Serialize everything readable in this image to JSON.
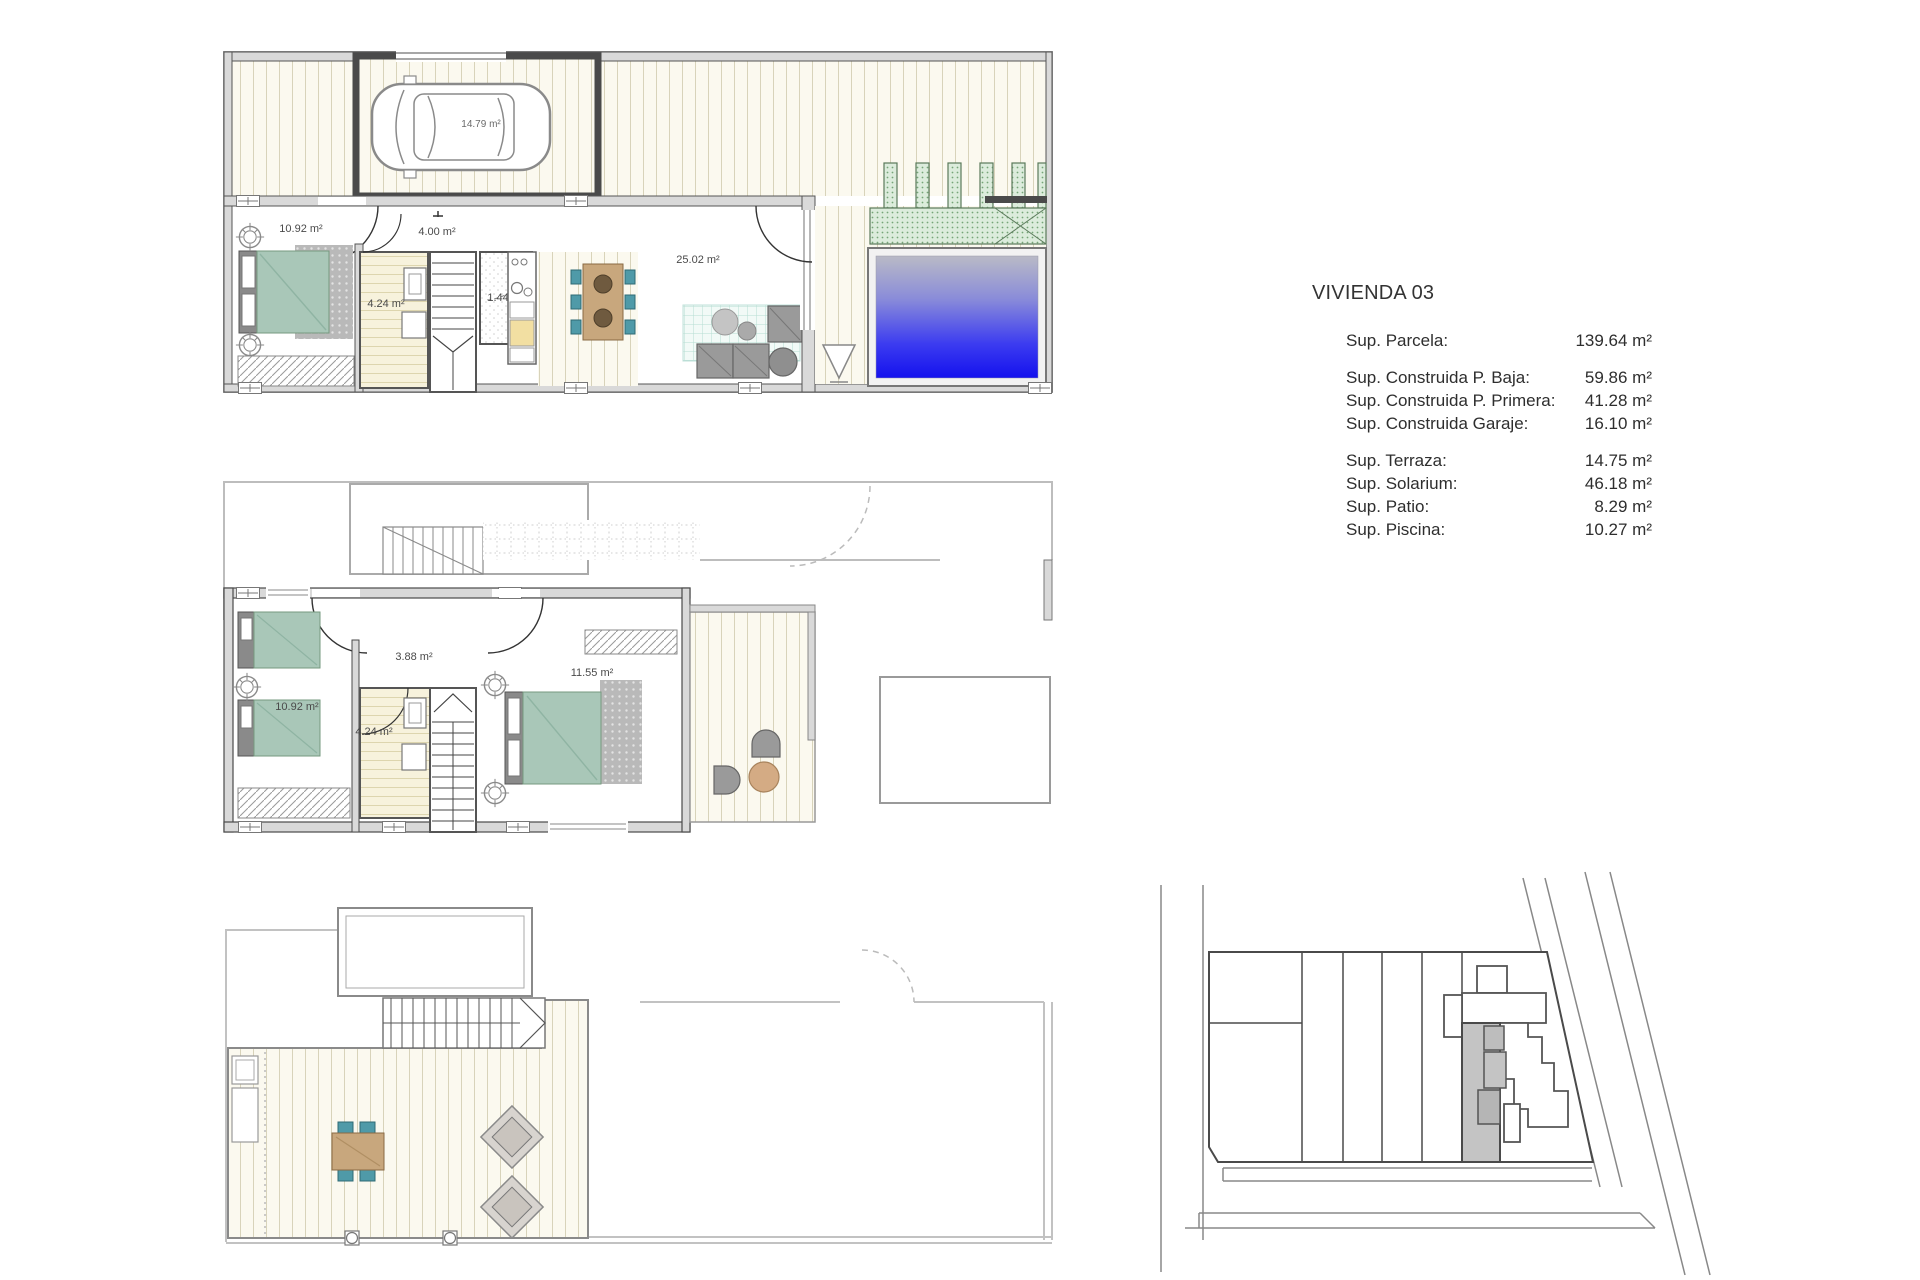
{
  "summary": {
    "title": "VIVIENDA 03",
    "rows": [
      {
        "label": "Sup. Parcela:",
        "value": "139.64 m²"
      },
      {
        "label": "Sup. Construida P. Baja:",
        "value": "59.86 m²"
      },
      {
        "label": "Sup. Construida P. Primera:",
        "value": "41.28 m²"
      },
      {
        "label": "Sup. Construida Garaje:",
        "value": "16.10 m²"
      },
      {
        "label": "Sup. Terraza:",
        "value": "14.75 m²"
      },
      {
        "label": "Sup. Solarium:",
        "value": "46.18 m²"
      },
      {
        "label": "Sup. Patio:",
        "value": "8.29 m²"
      },
      {
        "label": "Sup. Piscina:",
        "value": "10.27 m²"
      }
    ]
  },
  "plans": {
    "ground_floor": {
      "labels": [
        {
          "room": "garage",
          "text": "14.79 m²"
        },
        {
          "room": "bedroom",
          "text": "10.92 m²"
        },
        {
          "room": "hall",
          "text": "4.00 m²"
        },
        {
          "room": "bathroom",
          "text": "4.24 m²"
        },
        {
          "room": "wc",
          "text": "1.44 m²"
        },
        {
          "room": "living-room",
          "text": "25.02 m²"
        }
      ]
    },
    "first_floor": {
      "labels": [
        {
          "room": "bedroom",
          "text": "10.92 m²"
        },
        {
          "room": "hall",
          "text": "3.88 m²"
        },
        {
          "room": "bathroom",
          "text": "4.24 m²"
        },
        {
          "room": "master-bedroom",
          "text": "11.55 m²"
        }
      ]
    },
    "solarium": {
      "labels": []
    },
    "site_plan": {
      "labels": []
    }
  },
  "colors": {
    "pool_top": "#b9bac6",
    "pool_mid": "#6a6cdd",
    "pool_bottom": "#1411ee",
    "planter_green": "#d9ead9",
    "planter_border": "#5a7a5a",
    "deck_line": "#d8d3ba",
    "wall_fill": "#d9d9d9",
    "wall_edge": "#4a4a4a",
    "bed_teal": "#a9c7b8",
    "chair_teal": "#4f9aa8",
    "table_tan": "#c8a77d",
    "sofa_gray": "#9a9a9a",
    "ghost_gray": "#bdbdbd",
    "site_highlight": "#c4c4c4",
    "text": "#2e2e2e"
  }
}
